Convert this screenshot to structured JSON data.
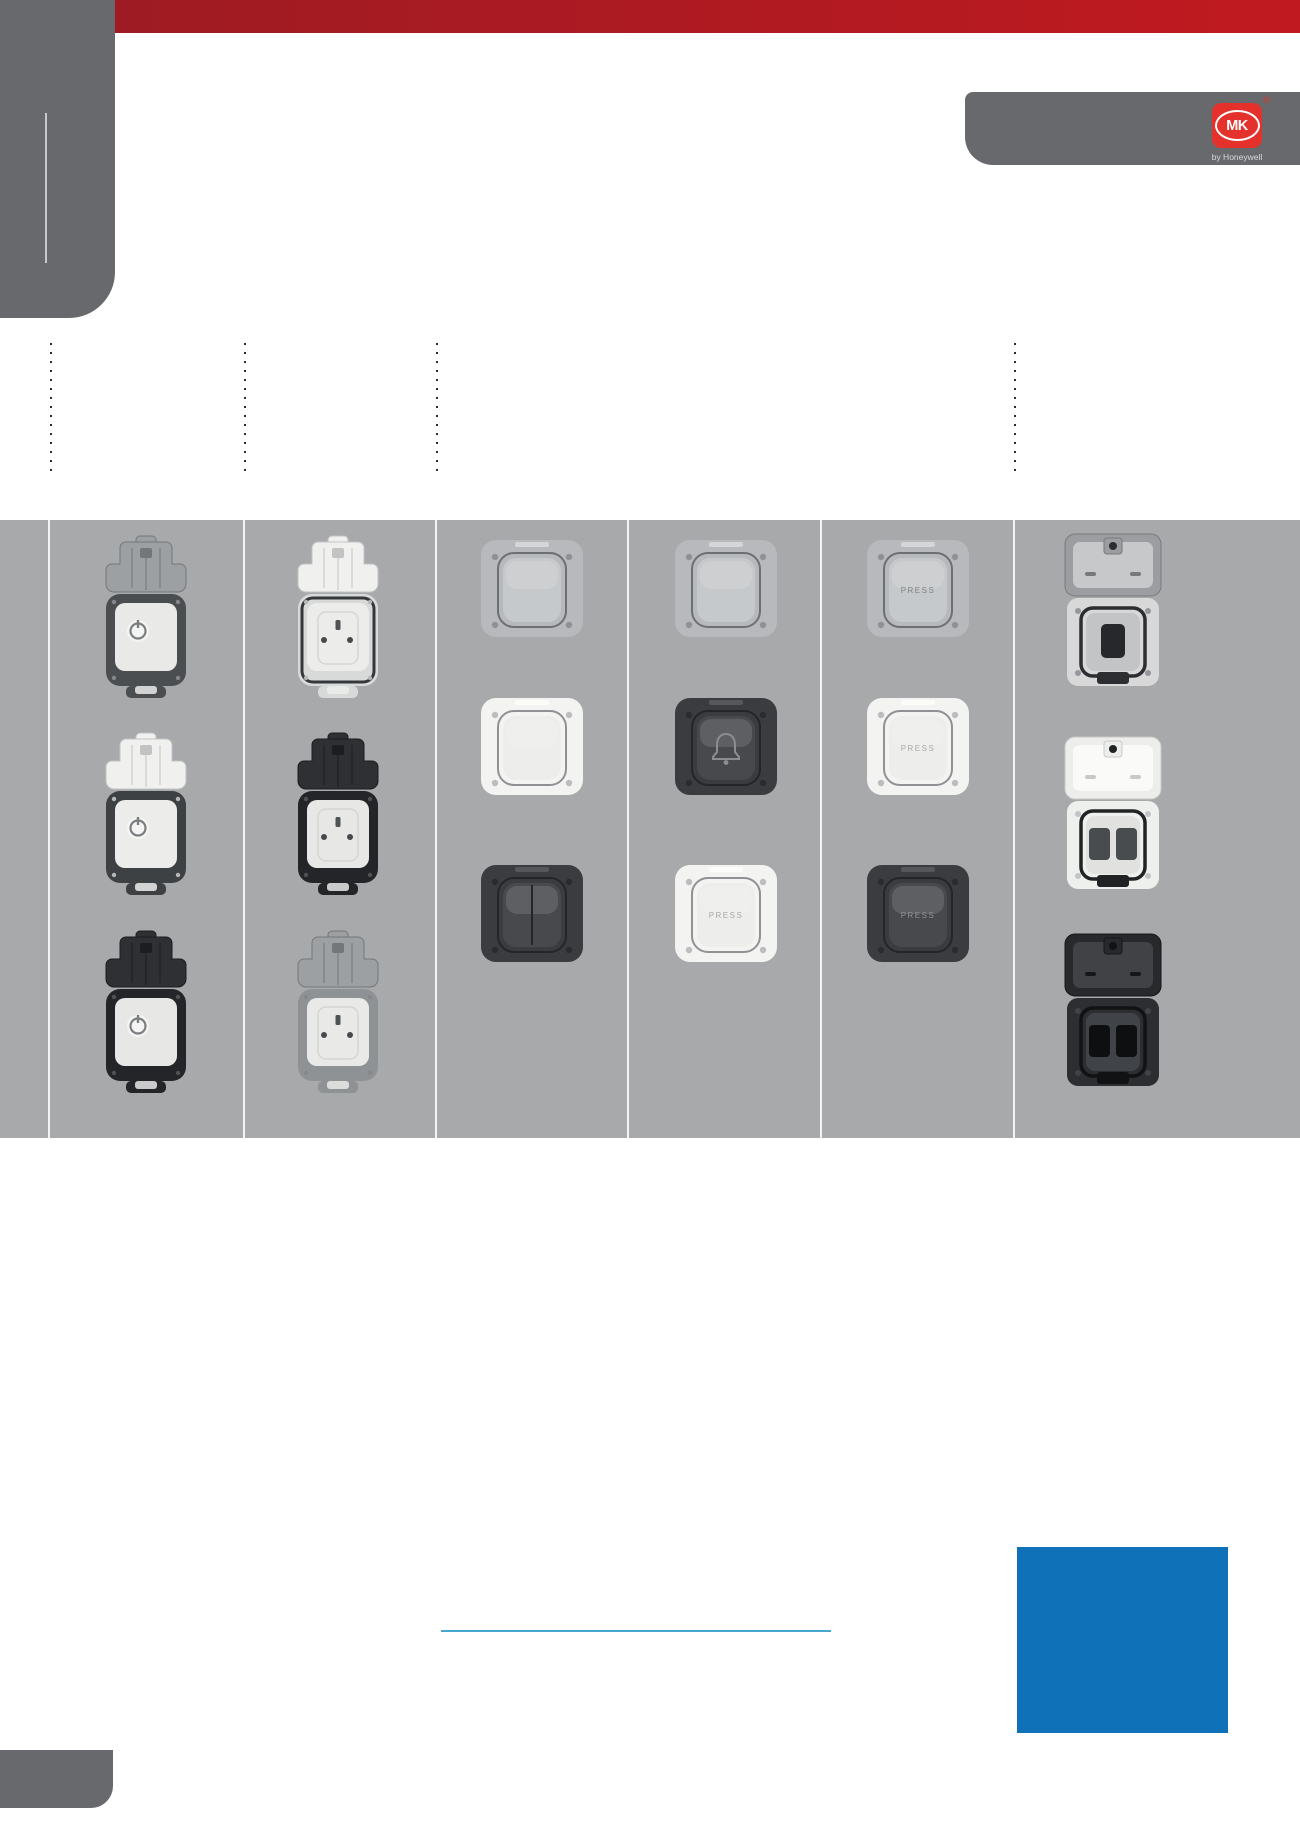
{
  "page": {
    "width": 1300,
    "height": 1839
  },
  "theme": {
    "red_bar_left": "#9b1b23",
    "red_bar_right": "#c01a20",
    "logo_red": "#e5312b",
    "grey_dark": "#67696c",
    "band_grey": "#a7a9ab",
    "separator_white": "#f4f4f2",
    "dot_black": "#2c2c2c",
    "blue_square": "#0f72b9",
    "blue_rule": "#48a7d0",
    "tagline_grey": "#d9dadb"
  },
  "logo": {
    "brand": "MK",
    "registered": "®",
    "tagline": "by Honeywell"
  },
  "band": {
    "columns": 6
  },
  "products": [
    {
      "id": "c1r1",
      "column": 1,
      "row": 1,
      "kind": "masterseal-switch",
      "colour": "grey",
      "icon": "power-icon"
    },
    {
      "id": "c1r2",
      "column": 1,
      "row": 2,
      "kind": "masterseal-switch",
      "colour": "white",
      "icon": "power-icon"
    },
    {
      "id": "c1r3",
      "column": 1,
      "row": 3,
      "kind": "masterseal-switch",
      "colour": "black",
      "icon": "power-icon"
    },
    {
      "id": "c2r1",
      "column": 2,
      "row": 1,
      "kind": "masterseal-socket",
      "colour": "white",
      "icon": "socket-pins"
    },
    {
      "id": "c2r2",
      "column": 2,
      "row": 2,
      "kind": "masterseal-socket",
      "colour": "black",
      "icon": "socket-pins"
    },
    {
      "id": "c2r3",
      "column": 2,
      "row": 3,
      "kind": "masterseal-socket",
      "colour": "grey",
      "icon": "socket-pins"
    },
    {
      "id": "c3r1",
      "column": 3,
      "row": 1,
      "kind": "plate-switch",
      "colour": "grey",
      "detail": "blank"
    },
    {
      "id": "c3r2",
      "column": 3,
      "row": 2,
      "kind": "plate-switch",
      "colour": "white",
      "detail": "blank"
    },
    {
      "id": "c3r3",
      "column": 3,
      "row": 3,
      "kind": "plate-switch",
      "colour": "black",
      "detail": "2gang"
    },
    {
      "id": "c4r1",
      "column": 4,
      "row": 1,
      "kind": "plate-switch",
      "colour": "grey",
      "detail": "blank"
    },
    {
      "id": "c4r2",
      "column": 4,
      "row": 2,
      "kind": "plate-switch",
      "colour": "black",
      "detail": "bell",
      "icon": "bell-icon"
    },
    {
      "id": "c4r3",
      "column": 4,
      "row": 3,
      "kind": "plate-switch",
      "colour": "white",
      "detail": "press",
      "label": "PRESS"
    },
    {
      "id": "c5r1",
      "column": 5,
      "row": 1,
      "kind": "plate-switch",
      "colour": "grey",
      "detail": "press",
      "label": "PRESS"
    },
    {
      "id": "c5r2",
      "column": 5,
      "row": 2,
      "kind": "plate-switch",
      "colour": "white",
      "detail": "press",
      "label": "PRESS"
    },
    {
      "id": "c5r3",
      "column": 5,
      "row": 3,
      "kind": "plate-switch",
      "colour": "black",
      "detail": "press",
      "label": "PRESS"
    },
    {
      "id": "c6r1",
      "column": 6,
      "row": 1,
      "kind": "lidded-socket-single",
      "colour": "grey"
    },
    {
      "id": "c6r2",
      "column": 6,
      "row": 2,
      "kind": "lidded-socket-double",
      "colour": "white"
    },
    {
      "id": "c6r3",
      "column": 6,
      "row": 3,
      "kind": "lidded-socket-double",
      "colour": "black"
    }
  ]
}
